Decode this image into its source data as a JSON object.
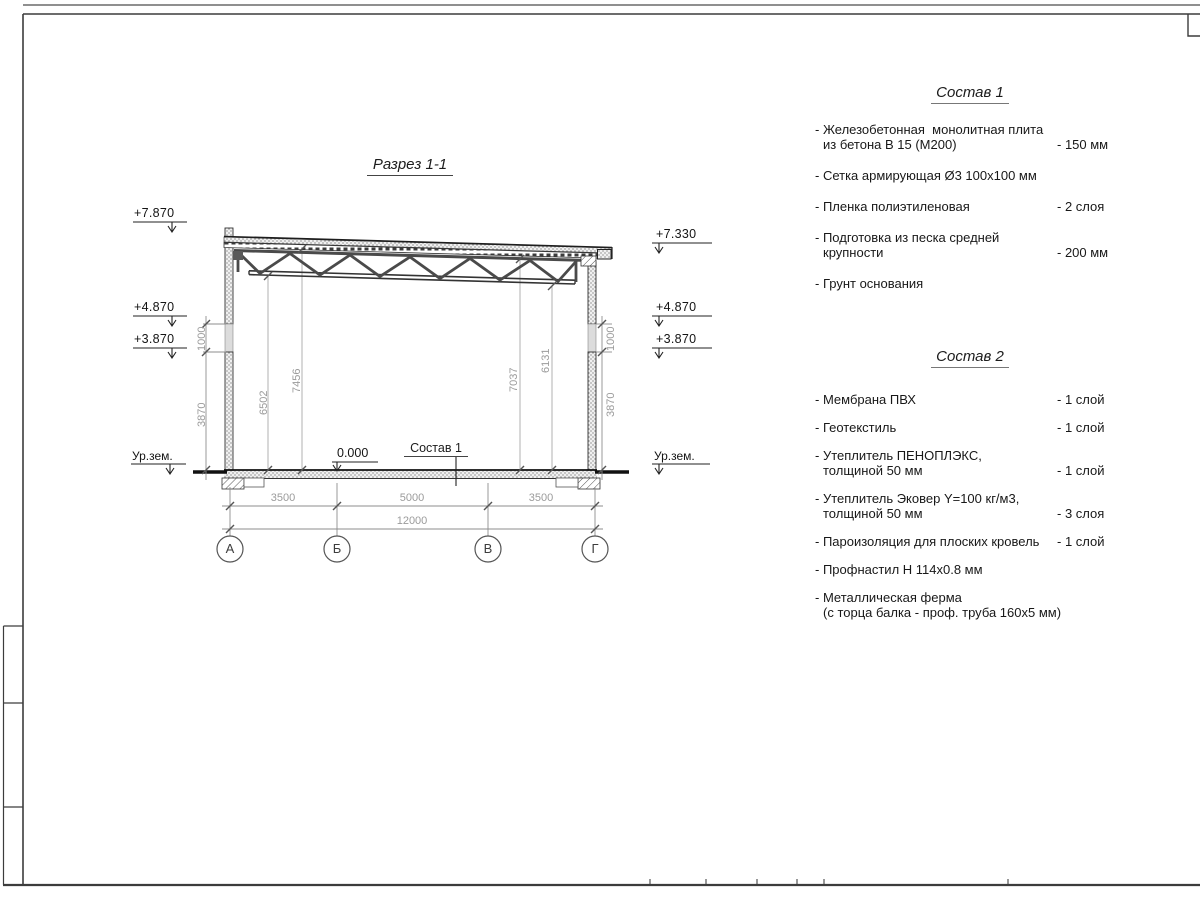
{
  "drawing": {
    "title": "Разрез 1-1",
    "floor_label": "Состав 1",
    "elevations": {
      "l_top": "+7.870",
      "l_mid": "+4.870",
      "l_low": "+3.870",
      "l_ground": "Ур.зем.",
      "r_top": "+7.330",
      "r_mid": "+4.870",
      "r_low": "+3.870",
      "r_ground": "Ур.зем.",
      "zero": "0.000"
    },
    "vdims": {
      "left_1000": "1000",
      "left_3870": "3870",
      "d6502": "6502",
      "d7456": "7456",
      "d7037": "7037",
      "d6131": "6131",
      "right_1000": "1000",
      "right_3870": "3870"
    },
    "hdims": {
      "s1": "3500",
      "s2": "5000",
      "s3": "3500",
      "total": "12000"
    },
    "axes": [
      "А",
      "Б",
      "В",
      "Г"
    ]
  },
  "sostav1": {
    "title": "Состав 1",
    "items": [
      {
        "lines": [
          "- Железобетонная  монолитная плита",
          "из бетона В 15 (М200)"
        ],
        "value": "- 150 мм"
      },
      {
        "lines": [
          "- Сетка армирующая Ø3 100x100 мм"
        ],
        "value": ""
      },
      {
        "lines": [
          "- Пленка полиэтиленовая"
        ],
        "value": "-  2 слоя"
      },
      {
        "lines": [
          "- Подготовка из песка средней",
          "крупности"
        ],
        "value": "- 200 мм"
      },
      {
        "lines": [
          "- Грунт основания"
        ],
        "value": ""
      }
    ]
  },
  "sostav2": {
    "title": "Состав 2",
    "items": [
      {
        "lines": [
          "- Мембрана ПВХ"
        ],
        "value": "- 1 слой"
      },
      {
        "lines": [
          "- Геотекстиль"
        ],
        "value": "- 1 слой"
      },
      {
        "lines": [
          "- Утеплитель ПЕНОПЛЭКС,",
          "толщиной 50 мм"
        ],
        "value": "- 1 слой"
      },
      {
        "lines": [
          "- Утеплитель Эковер Y=100 кг/м3,",
          "толщиной 50 мм"
        ],
        "value": "- 3 слоя"
      },
      {
        "lines": [
          "- Пароизоляция для плоских кровель"
        ],
        "value": "- 1 слой"
      },
      {
        "lines": [
          "- Профнастил Н 114x0.8 мм"
        ],
        "value": ""
      },
      {
        "lines": [
          "- Металлическая ферма",
          "(с торца балка - проф. труба 160x5 мм)"
        ],
        "value": ""
      }
    ]
  }
}
